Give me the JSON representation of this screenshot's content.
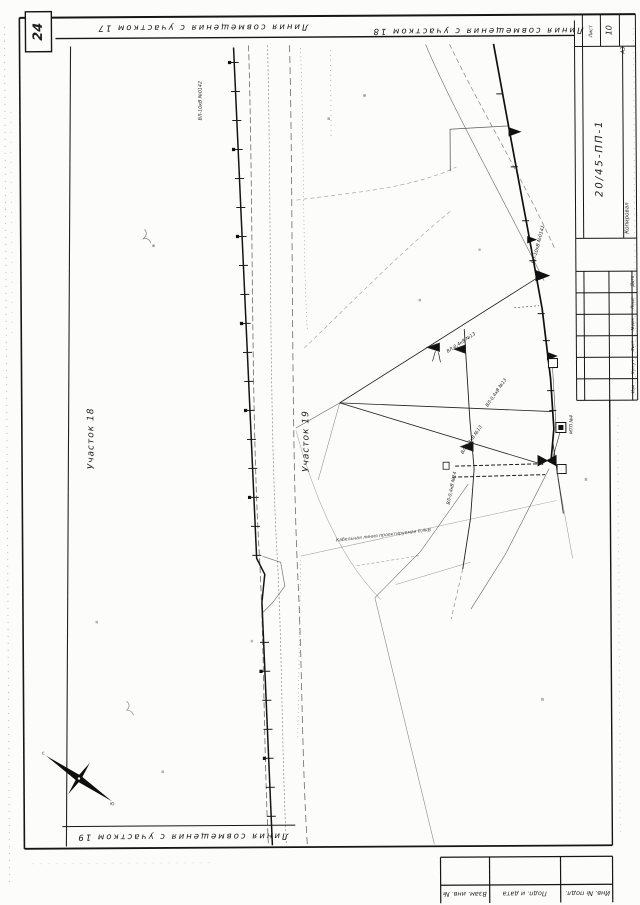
{
  "sheet": {
    "page_number": "24",
    "doc_number": "20/45-ПП-1",
    "kopiroval": "Копировал",
    "sheet_label": "Лист",
    "sheet_value": "10",
    "format": "А3"
  },
  "match_lines": {
    "top_left": "Линия совмещения с участком 17",
    "top_right": "Линия совмещения с участком 18",
    "bottom": "Линия совмещения с участком 19"
  },
  "parcels": {
    "parcel_18": "Участок 18",
    "parcel_19": "Участок 19"
  },
  "network_labels": {
    "vl10_0142": "ВЛ-10кВ №0142",
    "vl10_0141": "ВЛ-10кВ №0141",
    "vl04_13a": "ВЛ-0,4кВ №13",
    "vl04_13b": "ВЛ-0,4кВ №13",
    "vl04_13c": "ВЛ-0,4кВ №13",
    "vl04_14": "ВЛ-0,4кВ №14",
    "mtp4": "МТП №4",
    "cable_note": "Кабельная линия проектируемая 0,4кВ"
  },
  "title_block": {
    "rows": [
      "Дата",
      "Подп",
      "№док",
      "Лист",
      "Кол.уч",
      "Изм"
    ]
  },
  "side_table": {
    "cells": [
      "Взам. инв. №",
      "Подп. и дата",
      "Инв. № подл."
    ]
  },
  "compass": {
    "north": "С",
    "south": "Ю"
  }
}
